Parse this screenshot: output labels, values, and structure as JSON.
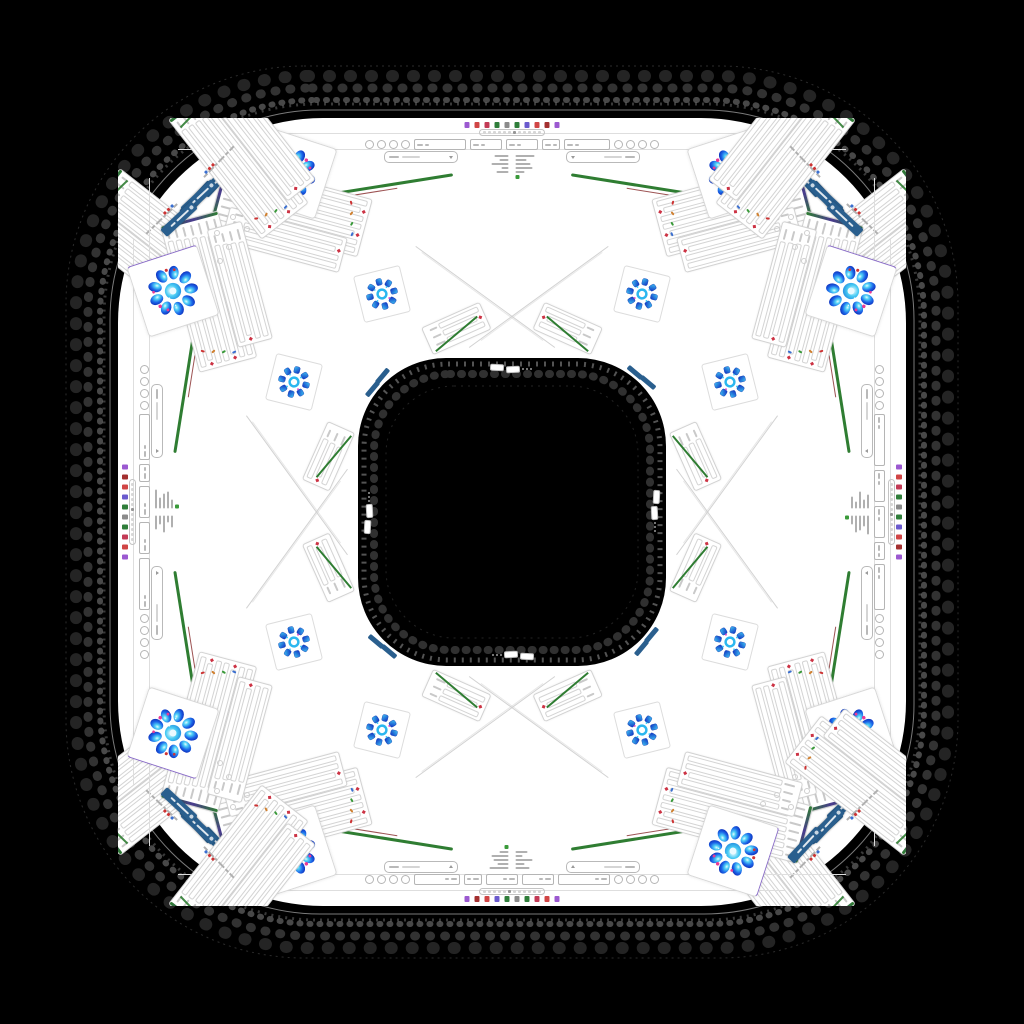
{
  "window": {
    "background": "#000000",
    "ring_fill": "#ffffff",
    "hole_fill": "#000000",
    "lace_color": "#8f8f8f"
  },
  "browser": {
    "favicon_colors": [
      "#9b59d0",
      "#d04545",
      "#c23a55",
      "#2f7d3a",
      "#8a8a8a",
      "#2f7d3a",
      "#6a5acd",
      "#d04545",
      "#a33030",
      "#9b59d0"
    ],
    "tab_dot_count": 12
  },
  "toolbar": {
    "round_buttons_per_group": 4,
    "dropdown_boxes": 4
  },
  "metadata_block": {
    "rows": 5,
    "left_col_widths": [
      14,
      9,
      17,
      7,
      12
    ],
    "right_col_widths": [
      19,
      11,
      15,
      17,
      9
    ],
    "status_chip_color": "#3a9a3a"
  },
  "fields": {
    "per_side": 1
  },
  "panels": {
    "rows_primary": 7,
    "rows_secondary": 4,
    "stripe_green": "#2f7d32",
    "stripe_purple": "#4a3b8f",
    "line_red": "#8b3434",
    "marker_red": "#cc3344",
    "tick_colors": [
      "#cc3333",
      "#d08030",
      "#3a9a3a",
      "#3a6fd0"
    ]
  },
  "pills": {
    "fill": "#2a5f8e",
    "glyph_color": "#ffffff"
  },
  "flowers": {
    "large_petal_count": 9,
    "large_palette": [
      "#0b1fae",
      "#1b66e8",
      "#52d4f7",
      "#e8fbff"
    ],
    "accent_pink": "#e83a96",
    "accent_red": "#cf3333",
    "gem_count": 8,
    "gem_palette": [
      "#0e2cc0",
      "#3fc6f4"
    ],
    "center_ring_color": "#2bb7ef"
  },
  "corner_bit_colors": [
    "#cc3333",
    "#cc3333",
    "#3a6fd0"
  ]
}
